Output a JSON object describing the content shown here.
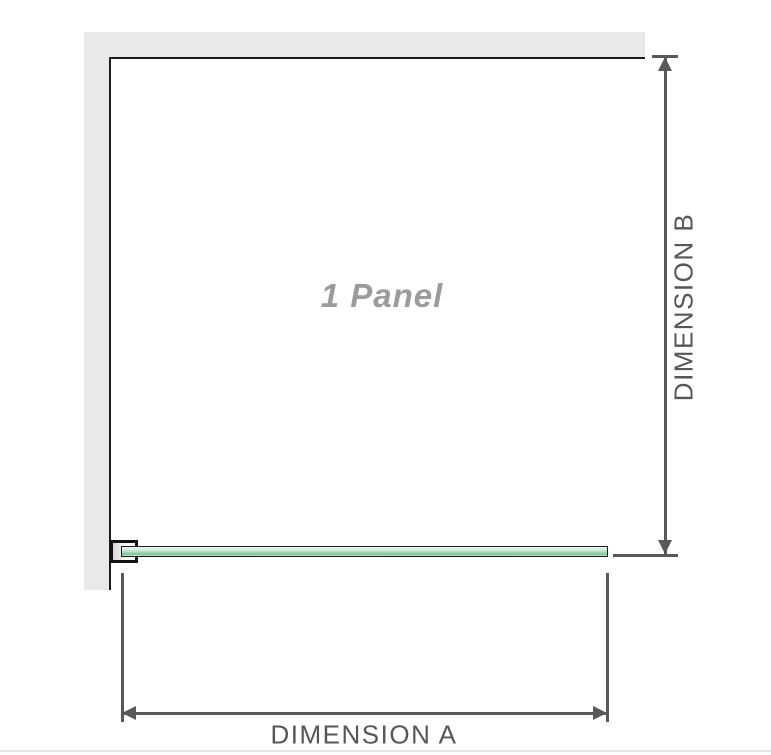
{
  "diagram": {
    "panel_label": "1 Panel",
    "dimensions": {
      "a_label": "DIMENSION A",
      "b_label": "DIMENSION B"
    },
    "colors": {
      "wall_gray": "#e9e9e9",
      "panel_outline_black": "#1a1a1a",
      "dimension_line_gray": "#58595b",
      "dimension_text_gray": "#54565a",
      "panel_label_gray": "#9b9b9b",
      "glass_green_light": "#dff1e6",
      "glass_green_dark": "#7ac698"
    }
  }
}
